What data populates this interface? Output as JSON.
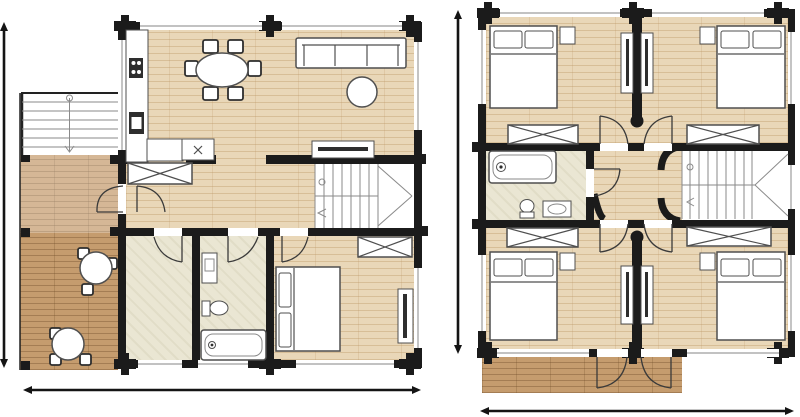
{
  "page": {
    "title": "House floor plans",
    "background": "#ffffff"
  },
  "colors": {
    "wall": "#1b1b1b",
    "wood_floor": "#e9d7b8",
    "wood_line": "#c9a878",
    "tile_floor": "#eae6d3",
    "deck_floor": "#c59c6e",
    "furn_stroke": "#4f4f4f",
    "dark_fixture": "#2e2e2e",
    "stair_line": "#8a8a8a",
    "door_line": "#3a3a3a",
    "window_line": "#9d9d9d",
    "dim_line": "#141414",
    "white": "#ffffff",
    "page_bg": "#ffffff"
  },
  "plans": {
    "ground_floor": {
      "name": "ground-floor",
      "rooms": [
        "kitchen-dining-area",
        "living-area",
        "hallway",
        "utility-room",
        "bathroom",
        "bedroom",
        "staircase",
        "terrace",
        "exterior-stairs"
      ],
      "furniture": [
        "kitchen-counter",
        "cooktop",
        "kitchen-sink",
        "counter-appliance",
        "dining-table",
        "6-dining-chairs",
        "sofa",
        "coffee-table",
        "tv-sideboard",
        "hall-wardrobe",
        "bedroom-wardrobe",
        "double-bed",
        "2-pillows",
        "dresser",
        "washbasin",
        "toilet",
        "bathtub",
        "2-terrace-tables",
        "terrace-chairs"
      ]
    },
    "upper_floor": {
      "name": "upper-floor",
      "rooms": [
        "bedroom-top-left",
        "bedroom-top-right",
        "bedroom-bottom-left",
        "bedroom-bottom-right",
        "bathroom",
        "hallway",
        "staircase",
        "balcony"
      ],
      "furniture": [
        "4-double-beds",
        "4-nightstands",
        "4-wardrobe-xboxes",
        "2-central-closet-pairs",
        "bathtub",
        "toilet",
        "washbasin"
      ]
    }
  },
  "dimension_lines": [
    {
      "plan": "ground-floor",
      "orientation": "vertical",
      "side": "left"
    },
    {
      "plan": "ground-floor",
      "orientation": "horizontal",
      "side": "bottom"
    },
    {
      "plan": "upper-floor",
      "orientation": "vertical",
      "side": "left"
    },
    {
      "plan": "upper-floor",
      "orientation": "horizontal",
      "side": "bottom"
    }
  ]
}
